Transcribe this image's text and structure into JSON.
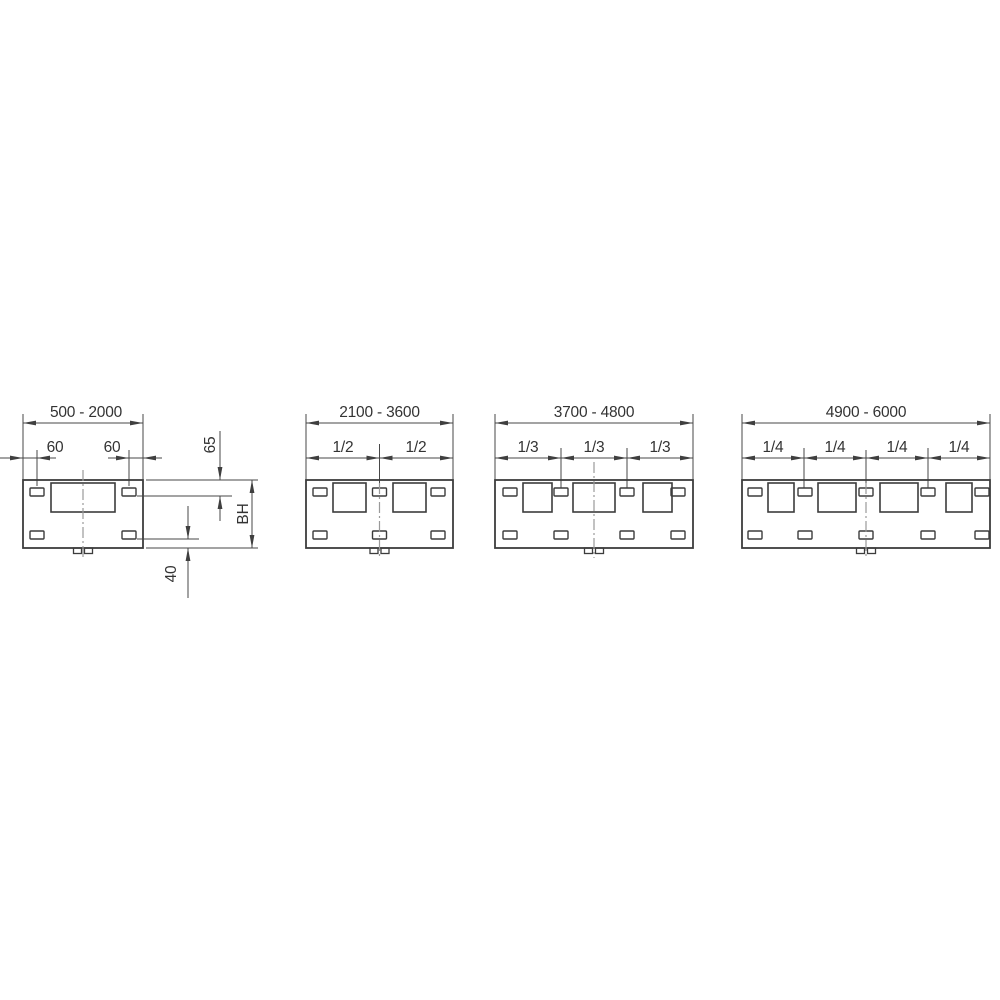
{
  "diagram": {
    "background": "#ffffff",
    "line_color": "#3f3f3f",
    "centerline_color": "#9a9a9a",
    "drawings": [
      {
        "range": "500 - 2000",
        "offset_left": "60",
        "offset_right": "60",
        "top_edge_to_slot": "65",
        "panel_height": "BH",
        "bottom_edge_to_slot": "40"
      },
      {
        "range": "2100 - 3600",
        "fractions": [
          "1/2",
          "1/2"
        ]
      },
      {
        "range": "3700 - 4800",
        "fractions": [
          "1/3",
          "1/3",
          "1/3"
        ]
      },
      {
        "range": "4900 - 6000",
        "fractions": [
          "1/4",
          "1/4",
          "1/4",
          "1/4"
        ]
      }
    ]
  }
}
